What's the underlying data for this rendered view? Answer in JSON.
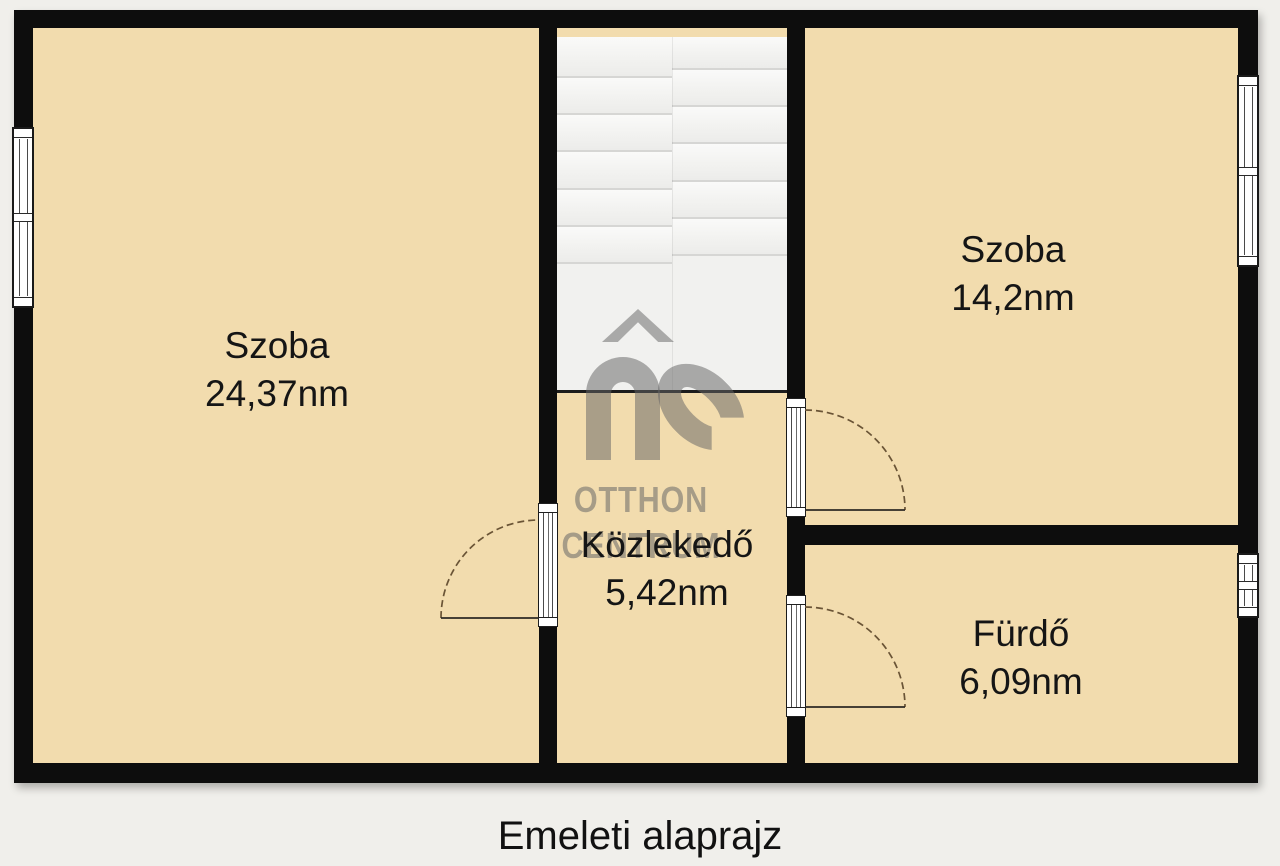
{
  "caption": "Emeleti alaprajz",
  "plan": {
    "rooms": [
      {
        "id": "szoba-left",
        "name": "Szoba",
        "area": "24,37nm"
      },
      {
        "id": "szoba-right",
        "name": "Szoba",
        "area": "14,2nm"
      },
      {
        "id": "kozlekedo",
        "name": "Közlekedő",
        "area": "5,42nm"
      },
      {
        "id": "furdo",
        "name": "Fürdő",
        "area": "6,09nm"
      }
    ]
  },
  "watermark": {
    "logo_letters": "OC",
    "line1": "OTTHON",
    "line2": "CENTRUM"
  },
  "colors": {
    "wall": "#0d0d0d",
    "floor": "#f2dcae",
    "background": "#f0efeb",
    "stairs": "#f1f1ef",
    "door_arc": "#6a5436",
    "label": "#151515"
  }
}
